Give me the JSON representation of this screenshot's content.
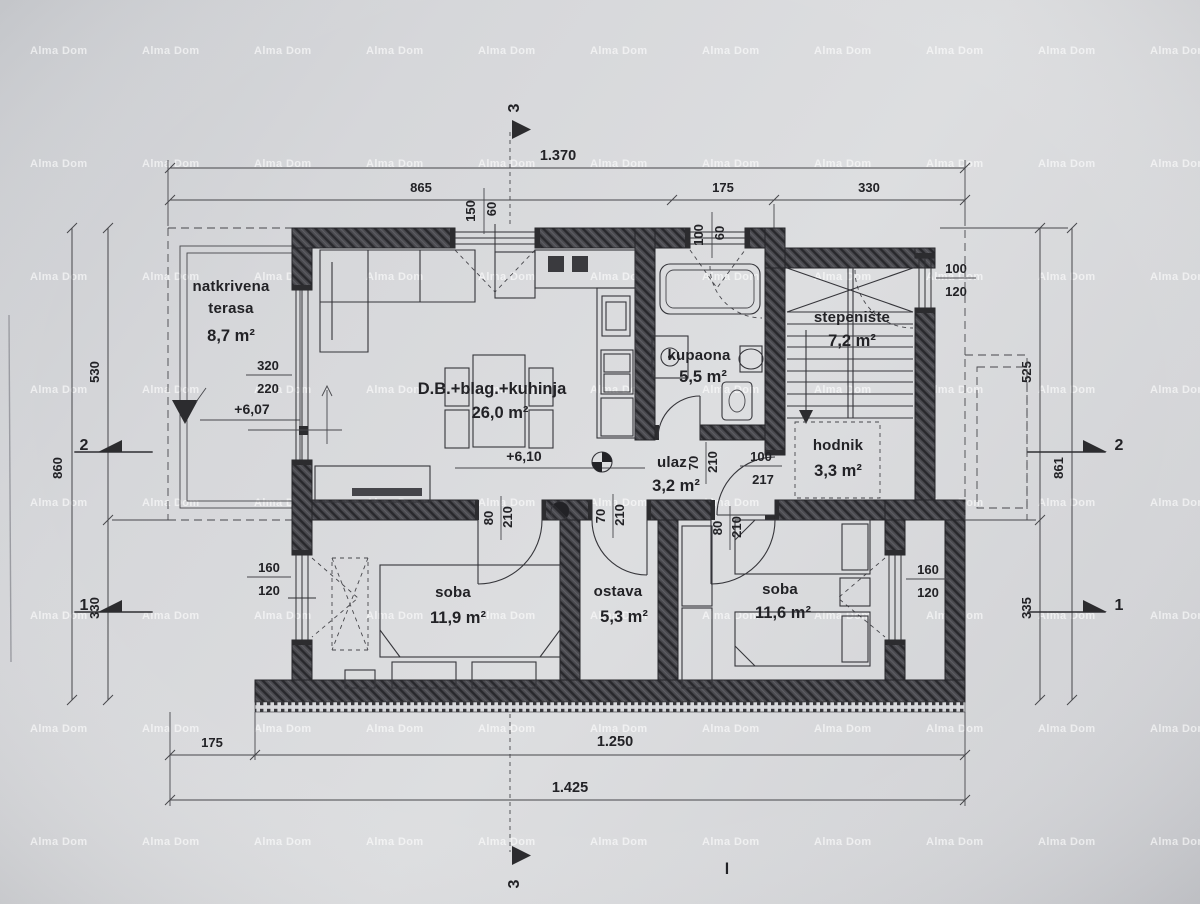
{
  "watermark": {
    "text": "Alma Dom"
  },
  "footer_mark": "l",
  "rooms": {
    "terrace": {
      "line1": "natkrivena",
      "line2": "terasa",
      "area": "8,7 m²"
    },
    "living": {
      "name": "D.B.+blag.+kuhinja",
      "area": "26,0 m²"
    },
    "bathroom": {
      "name": "kupaona",
      "area": "5,5 m²"
    },
    "staircase": {
      "name": "stepenište",
      "area": "7,2 m²"
    },
    "hallway": {
      "name": "hodnik",
      "area": "3,3 m²"
    },
    "entry": {
      "name": "ulaz",
      "area": "3,2 m²"
    },
    "bedroom1": {
      "name": "soba",
      "area": "11,9 m²"
    },
    "storage": {
      "name": "ostava",
      "area": "5,3 m²"
    },
    "bedroom2": {
      "name": "soba",
      "area": "11,6 m²"
    }
  },
  "levels": {
    "terrace": "+6,07",
    "interior": "+6,10"
  },
  "dims": {
    "top_total": "1.370",
    "top_seg1": "865",
    "top_seg2": "175",
    "top_seg3": "330",
    "left_seg1": "530",
    "left_seg2": "330",
    "left_total": "860",
    "right_seg1": "525",
    "right_seg2": "335",
    "right_total": "861",
    "bottom_seg1": "175",
    "bottom_seg2": "1.250",
    "bottom_total": "1.425"
  },
  "openings": {
    "living_window": {
      "w": "150",
      "h": "60"
    },
    "bath_window": {
      "w": "100",
      "h": "60"
    },
    "stair_window": {
      "w": "100",
      "h": "120"
    },
    "bedroom1_window": {
      "w": "160",
      "h": "120"
    },
    "bedroom2_window": {
      "w": "160",
      "h": "120"
    },
    "terrace_door": {
      "w": "320",
      "h": "220"
    },
    "bath_door": {
      "w": "70",
      "h": "210"
    },
    "bedroom1_door": {
      "w": "80",
      "h": "210"
    },
    "storage_door": {
      "w": "70",
      "h": "210"
    },
    "bedroom2_door": {
      "w": "80",
      "h": "210"
    },
    "entry_door": {
      "w": "100",
      "h": "217"
    }
  },
  "sections": {
    "s1": "1",
    "s2": "2",
    "s3": "3"
  }
}
